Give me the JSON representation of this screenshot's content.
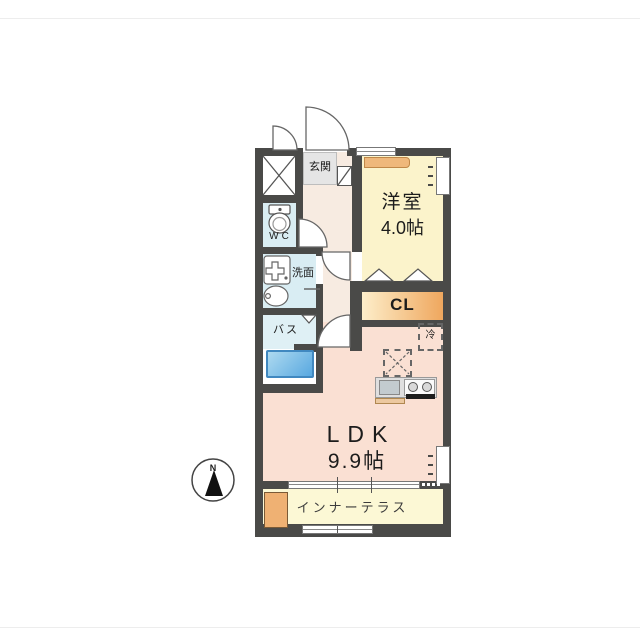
{
  "plan_title": "1LDK apartment floor plan",
  "compass": {
    "north_label": "N"
  },
  "rooms": {
    "genkan": {
      "label": "玄関"
    },
    "western_room": {
      "label": "洋室",
      "size": "4.0帖"
    },
    "wc": {
      "label": "WC"
    },
    "washroom": {
      "label": "洗面"
    },
    "bath": {
      "label": "バス"
    },
    "closet": {
      "label": "CL"
    },
    "refrigerator": {
      "label": "冷"
    },
    "ldk": {
      "label": "LDK",
      "size": "9.9帖"
    },
    "inner_terrace": {
      "label": "インナーテラス"
    }
  },
  "colors": {
    "wall": "#4a4a48",
    "western_room_bg": "#fbf3cb",
    "ldk_bg": "#fae0d3",
    "hallway_bg": "#f7ebe1",
    "wet_area_bg": "#d9edf3",
    "bath_bg": "#dff0f5",
    "bathtub_blue": "#58a8e0",
    "genkan_floor": "#e5e5e5",
    "closet_gradient_start": "#fdeeca",
    "closet_gradient_end": "#efa75e",
    "terrace_bg": "#fcf8d5",
    "accent_orange": "#efb173",
    "kitchen_counter": "#dfdfdf"
  }
}
